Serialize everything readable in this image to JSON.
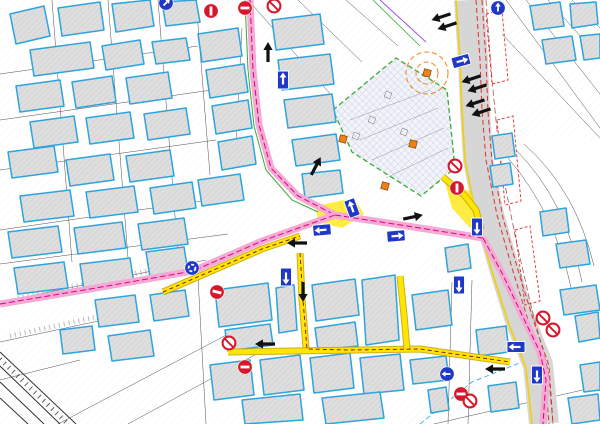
{
  "map": {
    "canvas": {
      "width": 600,
      "height": 424
    },
    "colors": {
      "building_outline": "#2da4dd",
      "building_fill": "#dedede",
      "building_hatch": "#c0c0c0",
      "parcel_line": "#4d4d4d",
      "road_gray": "#d6d6d6",
      "route_pink": "#f3aad4",
      "route_magenta": "#e5007e",
      "route_yellow": "#ffe600",
      "route_yellow_casing": "#c9a50b",
      "route_dark_red": "#8b1a1a",
      "green_line": "#3aaa35",
      "orange": "#f08019",
      "sign_red": "#d7182a",
      "sign_blue": "#2038c8",
      "tram_red": "#e03030",
      "road_edge_yellow": "#f2d000",
      "rail": "#333333",
      "util_violet": "#9b59d0",
      "util_green": "#3aaa35",
      "util_cyan": "#36b0e0",
      "constr_inner": "#8a93b0",
      "road_east_line": "#b05050"
    },
    "buildings": [
      "10,14 44,6 50,36 16,44",
      "58,8 100,2 104,30 62,36",
      "112,4 150,0 154,26 116,32",
      "162,2 196,0 200,22 166,26",
      "30,50 90,42 94,68 34,76",
      "102,46 140,40 144,64 106,70",
      "152,42 186,38 190,60 156,64",
      "16,86 60,80 64,106 20,112",
      "72,82 112,76 116,102 76,108",
      "126,78 168,72 172,98 130,104",
      "30,122 74,116 78,142 34,148",
      "86,118 130,112 134,138 90,144",
      "144,114 186,108 190,134 148,140",
      "8,152 54,146 58,172 12,178",
      "66,160 110,154 114,180 70,186",
      "126,156 170,150 174,176 130,182",
      "20,196 70,190 74,216 24,222",
      "86,192 134,186 138,212 90,218",
      "150,188 192,182 196,208 154,214",
      "8,232 58,226 62,252 12,258",
      "74,228 122,222 126,248 78,254",
      "138,224 184,218 188,244 142,250",
      "14,268 64,262 68,288 18,294",
      "80,264 130,258 134,284 84,290",
      "146,252 184,247 188,272 150,277",
      "198,34 238,28 242,56 202,62",
      "206,70 244,64 248,92 210,98",
      "212,106 248,100 252,128 216,134",
      "218,142 252,136 256,164 222,170",
      "198,180 240,174 244,200 202,206",
      "272,20 320,14 324,44 276,50",
      "278,60 330,54 334,84 282,90",
      "284,100 332,94 336,122 288,128",
      "292,140 336,134 340,160 296,166",
      "302,174 340,170 343,193 305,198",
      "530,6 560,2 564,26 534,30",
      "570,4 596,2 598,24 572,28",
      "542,40 572,36 576,60 546,64",
      "580,36 600,34 600,58 584,60",
      "492,136 512,133 515,156 495,159",
      "490,166 510,163 513,184 493,187",
      "445,248 468,244 471,268 448,272",
      "540,212 566,208 569,232 543,236",
      "215,290 268,283 272,320 219,327",
      "225,330 270,324 273,345 228,351",
      "276,288 294,285 297,330 279,333",
      "312,285 355,279 359,315 316,321",
      "362,280 395,275 399,340 366,345",
      "315,328 355,322 358,346 318,350",
      "412,295 448,290 452,325 416,330",
      "210,365 250,360 254,395 214,400",
      "260,360 300,355 304,390 264,395",
      "310,358 350,353 354,388 314,393",
      "360,358 400,354 404,390 364,394",
      "242,400 300,394 303,420 245,424",
      "322,398 380,392 384,418 326,424",
      "410,360 446,356 449,380 413,384",
      "428,390 446,387 449,410 431,413",
      "476,330 506,326 509,352 479,356",
      "95,300 135,295 139,322 99,327",
      "150,295 185,290 189,316 154,321",
      "108,336 150,330 154,356 112,361",
      "60,330 92,326 95,350 63,354",
      "556,244 586,240 590,264 560,268",
      "560,290 596,285 600,310 564,315",
      "575,316 598,312 600,338 579,342",
      "580,365 600,362 600,390 584,392",
      "488,386 516,382 519,408 491,412",
      "568,398 598,394 600,420 572,424"
    ],
    "parcel_lines": [
      "M0,74 L198,46",
      "M0,120 L212,90",
      "M0,170 L216,140",
      "M0,230 L222,198",
      "M0,264 L228,234",
      "M52,0 L72,262",
      "M108,0 L128,258",
      "M158,0 L178,254",
      "M196,0 L210,175",
      "M242,28 L236,140",
      "M506,0 L600,128",
      "M526,0 L600,94",
      "M548,0 L600,58",
      "M572,0 L600,28",
      "M502,34 L600,138",
      "M516,150 Q566,200 582,282",
      "M508,158 Q556,214 572,292",
      "M524,144 Q576,190 594,266",
      "M0,302 L206,260",
      "M0,342 L122,316",
      "M58,424 L232,332",
      "M128,424 L260,352",
      "M0,380 L80,360",
      "M250,2 L332,96",
      "M298,0 L362,62",
      "M346,0 L398,46",
      "M434,424 L600,386",
      "M198,278 L206,424",
      "M452,282 L448,424",
      "M472,280 L468,424"
    ],
    "railway": [
      "M0,352 L76,424",
      "M0,366 L60,424",
      "M0,382 L44,424",
      "M0,398 L28,424"
    ],
    "railway_ties": "M0,359 L68,424",
    "slopes": [
      "M18,298 L172,266",
      "M10,336 L110,314"
    ],
    "utilities": {
      "violet": "M380,0 L426,42",
      "green": "M373,0 L420,46",
      "cyan": "M420,424 L472,382 L522,362",
      "road_east": [
        [
          486,
          0
        ],
        [
          492,
          80
        ],
        [
          500,
          160
        ],
        [
          516,
          240
        ],
        [
          532,
          310
        ],
        [
          548,
          370
        ],
        [
          553,
          424
        ]
      ]
    },
    "main_road": {
      "center": [
        [
          469,
          0
        ],
        [
          473,
          60
        ],
        [
          475,
          110
        ],
        [
          478,
          160
        ],
        [
          489,
          215
        ],
        [
          504,
          268
        ],
        [
          520,
          320
        ],
        [
          538,
          365
        ],
        [
          544,
          424
        ]
      ],
      "width": 30,
      "tram1": [
        [
          476,
          0
        ],
        [
          480,
          60
        ],
        [
          482,
          110
        ],
        [
          486,
          160
        ],
        [
          497,
          215
        ],
        [
          512,
          268
        ],
        [
          528,
          320
        ],
        [
          544,
          365
        ],
        [
          549,
          424
        ]
      ],
      "tram2": [
        [
          482,
          0
        ],
        [
          486,
          60
        ],
        [
          488,
          112
        ],
        [
          492,
          162
        ],
        [
          503,
          218
        ],
        [
          518,
          270
        ],
        [
          534,
          322
        ],
        [
          549,
          366
        ],
        [
          553,
          424
        ]
      ],
      "yellow_west": [
        [
          456,
          0
        ],
        [
          460,
          60
        ],
        [
          462,
          110
        ],
        [
          465,
          160
        ],
        [
          476,
          215
        ],
        [
          491,
          268
        ],
        [
          508,
          322
        ],
        [
          526,
          368
        ],
        [
          532,
          424
        ]
      ],
      "platforms": [
        "M486,14 l16,-4 l6,70 l-16,4 Z",
        "M497,120 l16,-4 l8,85 l-16,4 Z",
        "M515,230 l15,-4 l10,75 l-15,4 Z"
      ]
    },
    "construction": {
      "outline": "333,110 396,58 447,90 455,168 421,196 352,152",
      "inner_lines": [
        "M350,120 L430,90",
        "M360,140 L438,108",
        "M372,160 L444,128",
        "M386,178 L448,148"
      ],
      "inner_rects": [
        [
          388,
          95
        ],
        [
          372,
          120
        ],
        [
          404,
          132
        ],
        [
          356,
          136
        ]
      ],
      "circles": [
        {
          "x": 427,
          "y": 73,
          "r": 21
        },
        {
          "x": 427,
          "y": 73,
          "r": 11
        }
      ],
      "squares": [
        [
          427,
          73
        ],
        [
          343,
          139
        ],
        [
          413,
          144
        ],
        [
          385,
          186
        ]
      ]
    },
    "pink_routes": [
      [
        [
          250,
          0
        ],
        [
          253,
          70
        ],
        [
          259,
          125
        ],
        [
          271,
          168
        ],
        [
          298,
          196
        ],
        [
          335,
          215
        ]
      ],
      [
        [
          0,
          304
        ],
        [
          90,
          289
        ],
        [
          193,
          271
        ],
        [
          262,
          241
        ],
        [
          335,
          215
        ]
      ],
      [
        [
          335,
          215
        ],
        [
          420,
          228
        ],
        [
          483,
          238
        ]
      ],
      [
        [
          483,
          238
        ],
        [
          503,
          275
        ],
        [
          522,
          315
        ],
        [
          540,
          352
        ],
        [
          546,
          380
        ],
        [
          543,
          424
        ]
      ]
    ],
    "green_routes": [
      [
        [
          245,
          0
        ],
        [
          248,
          70
        ],
        [
          254,
          126
        ],
        [
          266,
          170
        ],
        [
          292,
          200
        ],
        [
          318,
          212
        ]
      ]
    ],
    "yellow_routes": [
      [
        [
          163,
          292
        ],
        [
          262,
          249
        ],
        [
          300,
          236
        ]
      ],
      [
        [
          300,
          253
        ],
        [
          302,
          300
        ],
        [
          306,
          348
        ]
      ],
      [
        [
          228,
          352
        ],
        [
          420,
          349
        ],
        [
          510,
          362
        ]
      ],
      [
        [
          400,
          276
        ],
        [
          404,
          315
        ],
        [
          407,
          349
        ]
      ],
      [
        [
          443,
          177
        ],
        [
          465,
          196
        ],
        [
          476,
          210
        ],
        [
          481,
          230
        ]
      ]
    ],
    "yellow_patches": [
      "316,206 354,198 364,214 342,228 318,222",
      "443,176 470,192 481,216 470,228 452,208"
    ],
    "dark_red_routes": [
      [
        [
          300,
          253
        ],
        [
          303,
          300
        ],
        [
          307,
          349
        ],
        [
          350,
          350
        ],
        [
          420,
          349
        ],
        [
          510,
          362
        ]
      ],
      [
        [
          163,
          292
        ],
        [
          262,
          249
        ],
        [
          300,
          236
        ]
      ]
    ],
    "arrows": [
      {
        "x": 268,
        "y": 52,
        "rot": -90
      },
      {
        "x": 316,
        "y": 166,
        "rot": -62
      },
      {
        "x": 297,
        "y": 243,
        "rot": 180
      },
      {
        "x": 413,
        "y": 217,
        "rot": -12
      },
      {
        "x": 303,
        "y": 292,
        "rot": 90
      },
      {
        "x": 265,
        "y": 344,
        "rot": 180
      },
      {
        "x": 495,
        "y": 369,
        "rot": 180
      },
      {
        "x": 441,
        "y": 17,
        "rot": 162
      },
      {
        "x": 447,
        "y": 26,
        "rot": 162
      },
      {
        "x": 471,
        "y": 79,
        "rot": 162
      },
      {
        "x": 477,
        "y": 88,
        "rot": 162
      },
      {
        "x": 475,
        "y": 103,
        "rot": 162
      },
      {
        "x": 481,
        "y": 112,
        "rot": 162
      }
    ],
    "signs": [
      {
        "type": "no_entry",
        "x": 245,
        "y": 8,
        "rot": 0
      },
      {
        "type": "no_entry",
        "x": 211,
        "y": 11,
        "rot": 90
      },
      {
        "type": "no_entry",
        "x": 457,
        "y": 188,
        "rot": 90
      },
      {
        "type": "no_entry",
        "x": 217,
        "y": 292,
        "rot": 15
      },
      {
        "type": "no_entry",
        "x": 245,
        "y": 367,
        "rot": 0
      },
      {
        "type": "no_entry",
        "x": 461,
        "y": 394,
        "rot": 0
      },
      {
        "type": "slash",
        "x": 274,
        "y": 6
      },
      {
        "type": "slash",
        "x": 455,
        "y": 166
      },
      {
        "type": "slash",
        "x": 229,
        "y": 343
      },
      {
        "type": "slash",
        "x": 470,
        "y": 401
      },
      {
        "type": "slash",
        "x": 543,
        "y": 318
      },
      {
        "type": "slash",
        "x": 553,
        "y": 330
      },
      {
        "type": "one_way",
        "x": 461,
        "y": 61,
        "rot": -15
      },
      {
        "type": "one_way",
        "x": 283,
        "y": 80,
        "rot": -90
      },
      {
        "type": "one_way",
        "x": 352,
        "y": 208,
        "rot": -110
      },
      {
        "type": "one_way",
        "x": 322,
        "y": 230,
        "rot": 175
      },
      {
        "type": "one_way",
        "x": 396,
        "y": 236,
        "rot": -5
      },
      {
        "type": "one_way",
        "x": 477,
        "y": 227,
        "rot": 90
      },
      {
        "type": "one_way",
        "x": 286,
        "y": 277,
        "rot": 90
      },
      {
        "type": "one_way",
        "x": 459,
        "y": 285,
        "rot": 90
      },
      {
        "type": "one_way",
        "x": 516,
        "y": 347,
        "rot": 180
      },
      {
        "type": "one_way",
        "x": 537,
        "y": 375,
        "rot": 90
      },
      {
        "type": "roundabout",
        "x": 192,
        "y": 268
      },
      {
        "type": "blue_arrow",
        "x": 447,
        "y": 374,
        "rot": 180
      },
      {
        "type": "blue_arrow",
        "x": 166,
        "y": 3,
        "rot": -45
      },
      {
        "type": "blue_arrow",
        "x": 498,
        "y": 8,
        "rot": -90
      }
    ]
  }
}
